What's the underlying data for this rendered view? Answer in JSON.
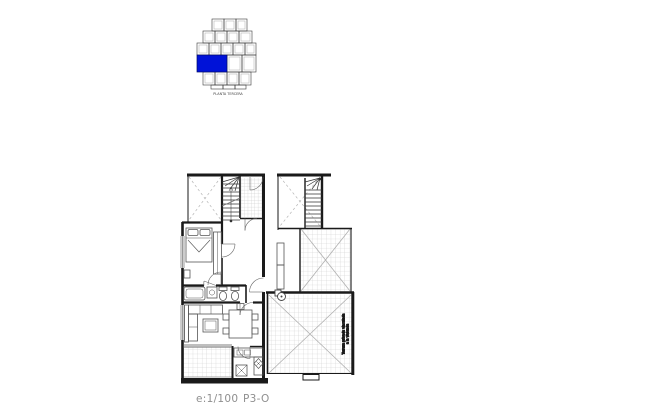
{
  "sheet": {
    "background": "#ffffff"
  },
  "key_plan": {
    "caption": "PLANTA TERCERA",
    "highlight_color": "#0012d8"
  },
  "plan": {
    "terrace_note_line1": "Terraza privada vinculada",
    "terrace_note_line2": "a la vivienda",
    "scale_label": "e:1/100",
    "sheet_code": "P3-O"
  }
}
